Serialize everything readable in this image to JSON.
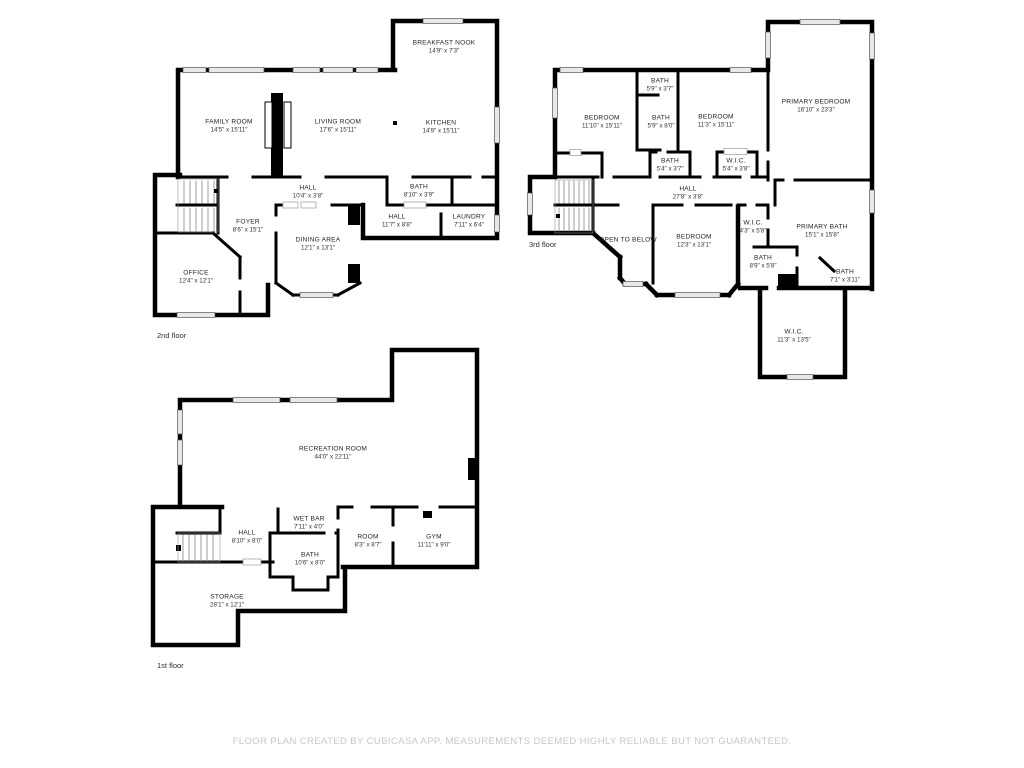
{
  "colors": {
    "wall": "#000000",
    "window_fill": "#e8e8e8",
    "footer_text": "#c7c7c7"
  },
  "floors": [
    {
      "id": "2nd-floor",
      "label": "2nd floor",
      "rooms": [
        {
          "name": "BREAKFAST NOOK",
          "dims": "14'9\" x 7'3\""
        },
        {
          "name": "FAMILY ROOM",
          "dims": "14'5\" x 15'11\""
        },
        {
          "name": "LIVING ROOM",
          "dims": "17'6\" x 15'11\""
        },
        {
          "name": "KITCHEN",
          "dims": "14'9\" x 15'11\""
        },
        {
          "name": "HALL",
          "dims": "10'4\" x 3'8\""
        },
        {
          "name": "FOYER",
          "dims": "8'6\" x 15'1\""
        },
        {
          "name": "DINING AREA",
          "dims": "12'1\" x 13'1\""
        },
        {
          "name": "BATH",
          "dims": "8'10\" x 3'9\""
        },
        {
          "name": "HALL",
          "dims": "11'7\" x 8'8\""
        },
        {
          "name": "LAUNDRY",
          "dims": "7'11\" x 6'4\""
        },
        {
          "name": "OFFICE",
          "dims": "12'4\" x 12'1\""
        }
      ]
    },
    {
      "id": "3rd-floor",
      "label": "3rd floor",
      "rooms": [
        {
          "name": "BATH",
          "dims": "5'9\" x 3'7\""
        },
        {
          "name": "BEDROOM",
          "dims": "11'10\" x 15'11\""
        },
        {
          "name": "BATH",
          "dims": "5'9\" x 8'0\""
        },
        {
          "name": "BEDROOM",
          "dims": "11'3\" x 15'11\""
        },
        {
          "name": "PRIMARY BEDROOM",
          "dims": "16'10\" x 23'3\""
        },
        {
          "name": "BATH",
          "dims": "5'4\" x 3'7\""
        },
        {
          "name": "W.I.C.",
          "dims": "5'4\" x 3'8\""
        },
        {
          "name": "HALL",
          "dims": "27'8\" x 3'8\""
        },
        {
          "name": "OPEN TO BELOW",
          "dims": ""
        },
        {
          "name": "BEDROOM",
          "dims": "12'3\" x 13'1\""
        },
        {
          "name": "W.I.C.",
          "dims": "4'3\" x 5'8\""
        },
        {
          "name": "PRIMARY BATH",
          "dims": "15'1\" x 15'8\""
        },
        {
          "name": "BATH",
          "dims": "8'9\" x 5'8\""
        },
        {
          "name": "BATH",
          "dims": "7'1\" x 3'11\""
        },
        {
          "name": "W.I.C.",
          "dims": "11'3\" x 13'5\""
        }
      ]
    },
    {
      "id": "1st-floor",
      "label": "1st floor",
      "rooms": [
        {
          "name": "RECREATION ROOM",
          "dims": "44'0\" x 22'11\""
        },
        {
          "name": "HALL",
          "dims": "8'10\" x 8'0\""
        },
        {
          "name": "WET BAR",
          "dims": "7'11\" x 4'0\""
        },
        {
          "name": "BATH",
          "dims": "10'6\" x 8'0\""
        },
        {
          "name": "ROOM",
          "dims": "8'3\" x 8'7\""
        },
        {
          "name": "GYM",
          "dims": "11'11\" x 9'0\""
        },
        {
          "name": "STORAGE",
          "dims": "28'1\" x 12'1\""
        }
      ]
    }
  ],
  "footer": {
    "text": "FLOOR PLAN CREATED BY CUBICASA APP. MEASUREMENTS DEEMED HIGHLY RELIABLE BUT NOT GUARANTEED."
  }
}
